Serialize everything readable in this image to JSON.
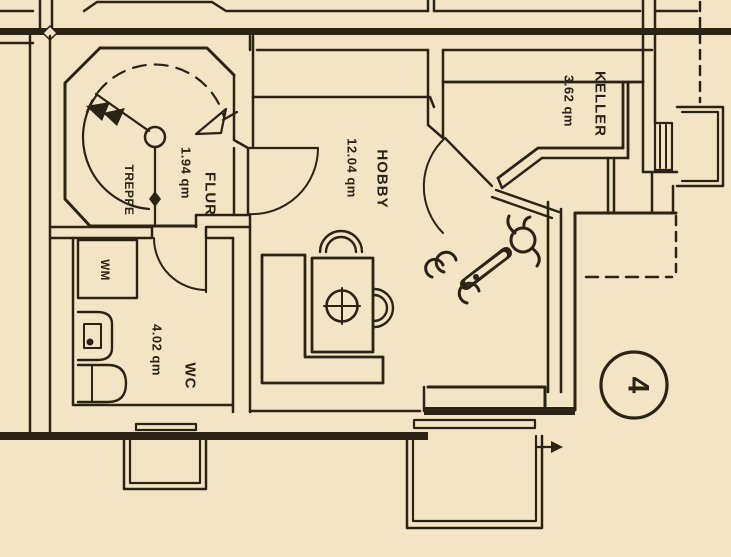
{
  "plan": {
    "title": "Kellergeschoss Grundriss-Ausschnitt",
    "rooms": {
      "treppe": {
        "label": "TREPPE"
      },
      "flur": {
        "label": "FLUR",
        "area": "1.94 qm"
      },
      "hobby": {
        "label": "HOBBY",
        "area": "12.04 qm"
      },
      "keller": {
        "label": "KELLER",
        "area": "3.62 qm"
      },
      "wc": {
        "label": "WC",
        "area": "4.02 qm"
      }
    },
    "fixtures": {
      "washing_machine_label": "WM"
    },
    "sheet_marker": {
      "number": "4"
    },
    "colors": {
      "paper": "#f1e5c4",
      "ink": "#2b2315"
    }
  }
}
